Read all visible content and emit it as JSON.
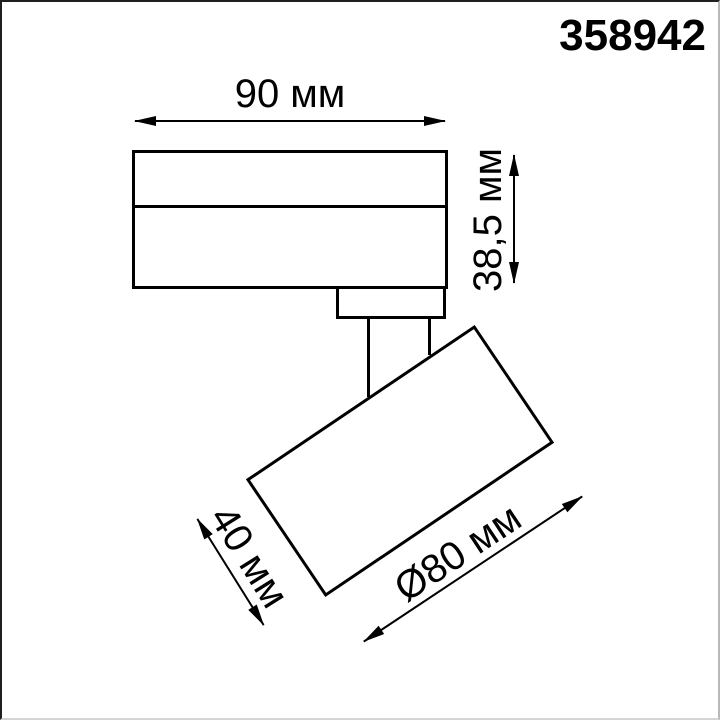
{
  "product_code": "358942",
  "labels": {
    "body_width": "90 мм",
    "body_height": "38,5 мм",
    "head_depth": "40 мм",
    "head_diameter": "Ø80 мм"
  },
  "colors": {
    "line": "#000000",
    "background": "#ffffff"
  }
}
